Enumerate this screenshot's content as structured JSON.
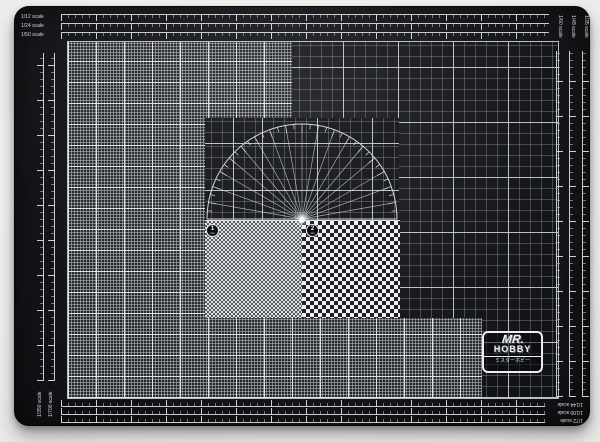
{
  "photo": {
    "background_color": "#f1f1ef",
    "subject": "cutting mat product photo"
  },
  "mat": {
    "surface_color": "#17181b",
    "line_color": "#d0d5da",
    "checker_light": "#eef0f1",
    "checker_dark": "#1d1f22",
    "scales": {
      "top": [
        "1/12 scale",
        "1/24 scale",
        "1/50 scale"
      ],
      "right": [
        "1/35 scale",
        "1/48 scale",
        "1/60 scale"
      ],
      "bottom": [
        "1/144 scale",
        "1/100 scale",
        "1/72 scale"
      ],
      "left": [
        "1/350 scale",
        "1/700 scale"
      ]
    },
    "protractor": {
      "degrees_max": 180,
      "ray_step_deg": 10,
      "tick_step_deg": 5
    },
    "checker_markers": [
      {
        "number": "1",
        "unit": "mm"
      },
      {
        "number": "2",
        "unit": "mm"
      }
    ],
    "brand": {
      "top": "MR.",
      "main": "HOBBY",
      "japanese": "ミスターホビー"
    }
  }
}
